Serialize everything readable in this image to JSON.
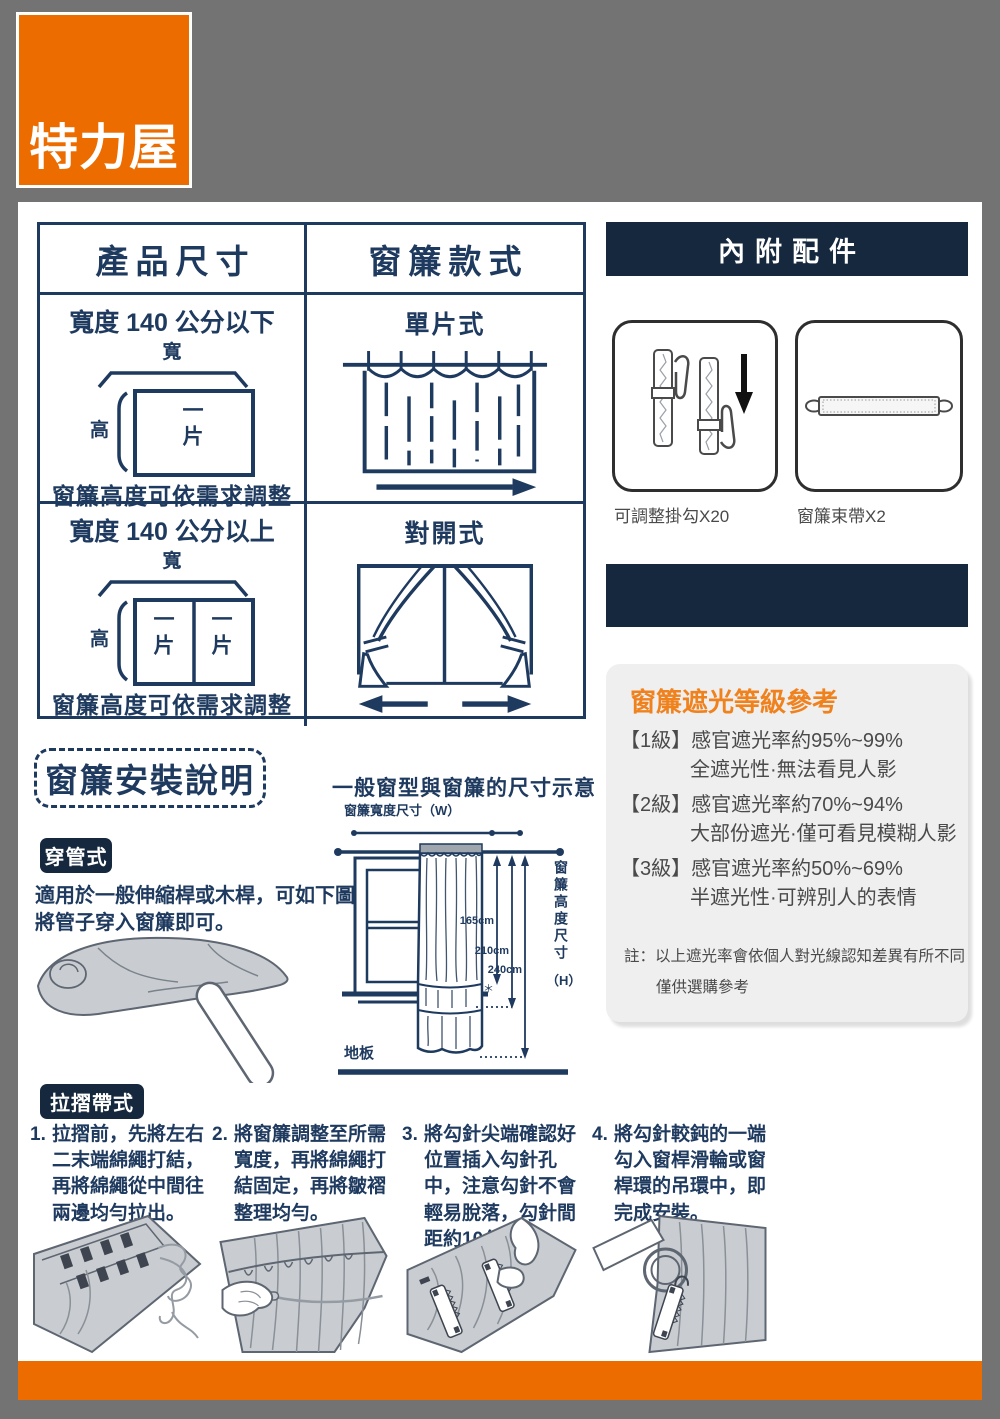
{
  "logo": "特力屋",
  "table": {
    "header_left": "產品尺寸",
    "header_right": "窗簾款式",
    "rows": [
      {
        "size_title": "寬度 140 公分以下",
        "width_label": "寬",
        "height_label": "高",
        "panels": [
          "一片"
        ],
        "caption": "窗簾高度可依需求調整",
        "style_title": "單片式"
      },
      {
        "size_title": "寬度 140 公分以上",
        "width_label": "寬",
        "height_label": "高",
        "panels": [
          "一片",
          "一片"
        ],
        "caption": "窗簾高度可依需求調整",
        "style_title": "對開式"
      }
    ]
  },
  "accessories": {
    "title": "內附配件",
    "items": [
      {
        "label": "可調整掛勾X20",
        "icon": "adjustable-curtain-hooks-icon"
      },
      {
        "label": "窗簾束帶X2",
        "icon": "curtain-tieback-icon"
      }
    ]
  },
  "blackout": {
    "title": "窗簾遮光等級參考",
    "levels": [
      {
        "grade": "【1級】",
        "rate": "感官遮光率約95%~99%",
        "desc": "全遮光性·無法看見人影"
      },
      {
        "grade": "【2級】",
        "rate": "感官遮光率約70%~94%",
        "desc": "大部份遮光·僅可看見模糊人影"
      },
      {
        "grade": "【3級】",
        "rate": "感官遮光率約50%~69%",
        "desc": "半遮光性·可辨別人的表情"
      }
    ],
    "note1": "註：以上遮光率會依個人對光線認知差異有所不同",
    "note2": "僅供選購參考"
  },
  "install": {
    "title": "窗簾安裝說明",
    "diagram": {
      "title": "一般窗型與窗簾的尺寸示意",
      "width_label": "窗簾寬度尺寸（W）",
      "height_label": "窗簾高度尺寸",
      "height_suffix": "（H）",
      "floor": "地板",
      "m1": "165cm",
      "m2": "210cm",
      "m3": "240cm",
      "star": "＊"
    },
    "rod_type": {
      "badge": "穿管式",
      "desc": "適用於一般伸縮桿或木桿，可如下圖將管子穿入窗簾即可。"
    },
    "pleat_type": {
      "badge": "拉摺帶式",
      "steps": [
        {
          "num": "1.",
          "text": "拉摺前，先將左右二末端綿繩打結，再將綿繩從中間往兩邊均勻拉出。"
        },
        {
          "num": "2.",
          "text": "將窗簾調整至所需寬度，再將綿繩打結固定，再將皺褶整理均勻。"
        },
        {
          "num": "3.",
          "text": "將勾針尖端確認好位置插入勾針孔中，注意勾針不會輕易脫落，勾針間距約10公分。"
        },
        {
          "num": "4.",
          "text": "將勾針較鈍的一端勾入窗桿滑輪或窗桿環的吊環中，即完成安裝。"
        }
      ]
    }
  },
  "colors": {
    "brand_orange": "#ED6C00",
    "title_orange": "#F0821E",
    "navy_text": "#1F3A5F",
    "navy_bar": "#16283E",
    "background_gray": "#737373",
    "panel_gray": "#EFEFEF",
    "text_gray": "#4A4A4A"
  }
}
